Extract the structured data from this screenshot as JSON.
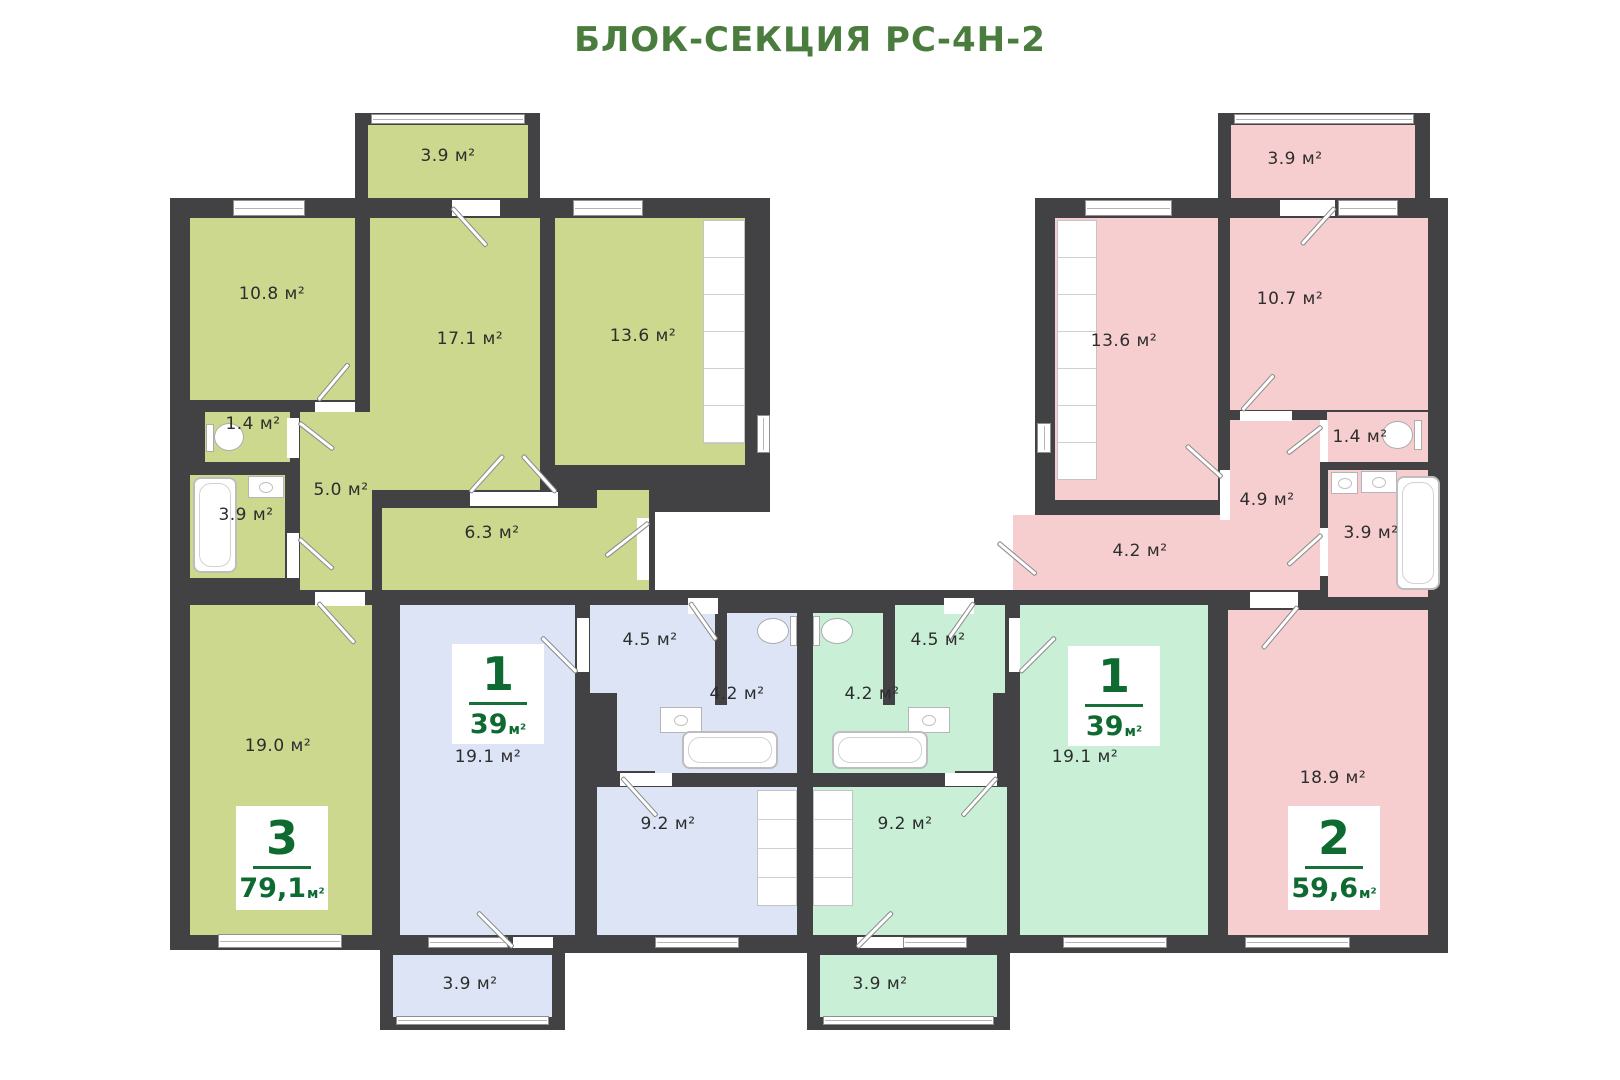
{
  "title": "БЛОК-СЕКЦИЯ РС-4Н-2",
  "colors": {
    "title_green": "#4a7c3d",
    "badge_green": "#0e6a31",
    "wall": "#424244",
    "apartment_3_fill": "#ccd88e",
    "apartment_1_left_fill": "#dce4f6",
    "apartment_1_right_fill": "#c9efd7",
    "apartment_2_fill": "#f7cecf"
  },
  "apartments": {
    "apt3": {
      "type_number": "3",
      "total_area": "79,1",
      "area_unit": "м²",
      "rooms": {
        "balcony": "3.9 м²",
        "bedroom1": "10.8 м²",
        "living": "17.1 м²",
        "bedroom2": "13.6 м²",
        "wc": "1.4 м²",
        "bath": "3.9 м²",
        "hall": "5.0 м²",
        "corridor": "6.3 м²",
        "room19": "19.0 м²"
      }
    },
    "apt1L": {
      "type_number": "1",
      "total_area": "39",
      "area_unit": "м²",
      "rooms": {
        "living": "19.1 м²",
        "hall": "4.5 м²",
        "bath": "4.2 м²",
        "kitchen": "9.2 м²",
        "balcony": "3.9 м²"
      }
    },
    "apt1R": {
      "type_number": "1",
      "total_area": "39",
      "area_unit": "м²",
      "rooms": {
        "living": "19.1 м²",
        "hall": "4.5 м²",
        "bath": "4.2 м²",
        "kitchen": "9.2 м²",
        "balcony": "3.9 м²"
      }
    },
    "apt2": {
      "type_number": "2",
      "total_area": "59,6",
      "area_unit": "м²",
      "rooms": {
        "balcony": "3.9 м²",
        "bedroom1": "13.6 м²",
        "bedroom2": "10.7 м²",
        "wc": "1.4 м²",
        "hall": "4.9 м²",
        "corridor": "4.2 м²",
        "bath": "3.9 м²",
        "room19": "18.9 м²"
      }
    }
  }
}
